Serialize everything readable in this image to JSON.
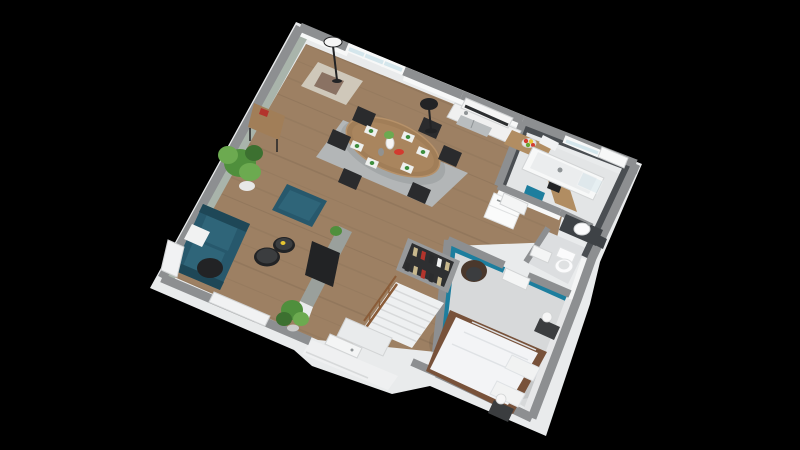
{
  "title": "isometric-3d-floor-plan-render",
  "scene": {
    "background": "#000000",
    "view": "isometric-3d-cutaway",
    "rooms": [
      "living-room",
      "dining-area",
      "open-kitchen",
      "hallway",
      "bathroom",
      "wc",
      "bedroom",
      "entry-porch",
      "staircase"
    ],
    "furniture": [
      "sofa",
      "ottoman",
      "coffee-tables",
      "tv-partition",
      "plants",
      "console-table",
      "armchair",
      "floor-lamps",
      "dining-table",
      "dining-chairs",
      "place-settings",
      "kitchen-cabinets",
      "sink",
      "range-hood",
      "peninsula-counter",
      "fridge",
      "fruit-bowl",
      "blender",
      "coffee-machine",
      "bathtub",
      "shower-glass",
      "vanity-sink",
      "toilet",
      "double-bed",
      "pillows",
      "nightstands",
      "sphere-lamps",
      "wardrobe-clothes",
      "bedroom-chair",
      "stairs-with-railing",
      "radiators",
      "entry-door",
      "windows"
    ]
  },
  "colors": {
    "bg": "#000000",
    "ext": "#e9ebec",
    "wood": "#9d8063",
    "woodDark": "#7c6450",
    "floorGray": "#d7d9da",
    "floorBath": "#e3e5e6",
    "floorWC": "#dcdee0",
    "porch": "#eff0f1",
    "rugDining": "#b3b6b7",
    "wallTop": "#8d8f91",
    "sage": "#a9b4ab",
    "frameWhite": "#f7f8f8",
    "tile": "#4a4e52",
    "tileDark": "#3e4246",
    "doorWhite": "#f4f5f5",
    "wallLight": "#e6e7e8",
    "teal": "#1d7e9e",
    "glassBlue": "#cfe3ea",
    "counterEdge": "#d2d4d5",
    "counter": "#f0f0f0",
    "steel": "#b9bdbf",
    "steelDark": "#8f9496",
    "hood": "#f5f5f5",
    "hoodStripe": "#2d2f31",
    "counterWood": "#b18d62",
    "fruitRed": "#d23b2f",
    "fruitYellow": "#e6c531",
    "fruitGreen": "#69a733",
    "fridge": "#fafbfb",
    "fridgeShade": "#dfe1e2",
    "sofa": "#27586c",
    "sofaLight": "#2f6579",
    "sofaDark": "#1e4757",
    "pillow": "#f1f2f2",
    "black": "#222325",
    "dark": "#3b3d3f",
    "partition": "#9aa09c",
    "tableWood": "#a17e58",
    "tableWoodLight": "#b69169",
    "chairBlack": "#2a2b2d",
    "mat": "#eef0ee",
    "napkin": "#3e8e3e",
    "plant": "#4f8f3c",
    "plantLight": "#6caa50",
    "plantDark": "#3c7030",
    "pot": "#e7e7e7",
    "potGray": "#cccccc",
    "armchair": "#cfc8ba",
    "throwBrown": "#8a7263",
    "radiator": "#f1f2f3",
    "tub": "#f7f8f8",
    "tubInner": "#ebedee",
    "toilet": "#fbfbfc",
    "bedFrame": "#78523a",
    "duvet": "#f3f4f6",
    "duvetShade": "#dfe2e5",
    "nightstand": "#3b3d3f",
    "lamp": "#f6f6f6",
    "wardrobe": "#97999b",
    "wardrobeDark": "#2e2f31",
    "clothesRed": "#b3342c",
    "clothesTan": "#c8b88d",
    "clothesDark": "#2b2c2e",
    "stair": "#eef0f1",
    "stairShade": "#d7d9da",
    "rail": "#8a5c38",
    "chairBrown": "#4a382c"
  }
}
